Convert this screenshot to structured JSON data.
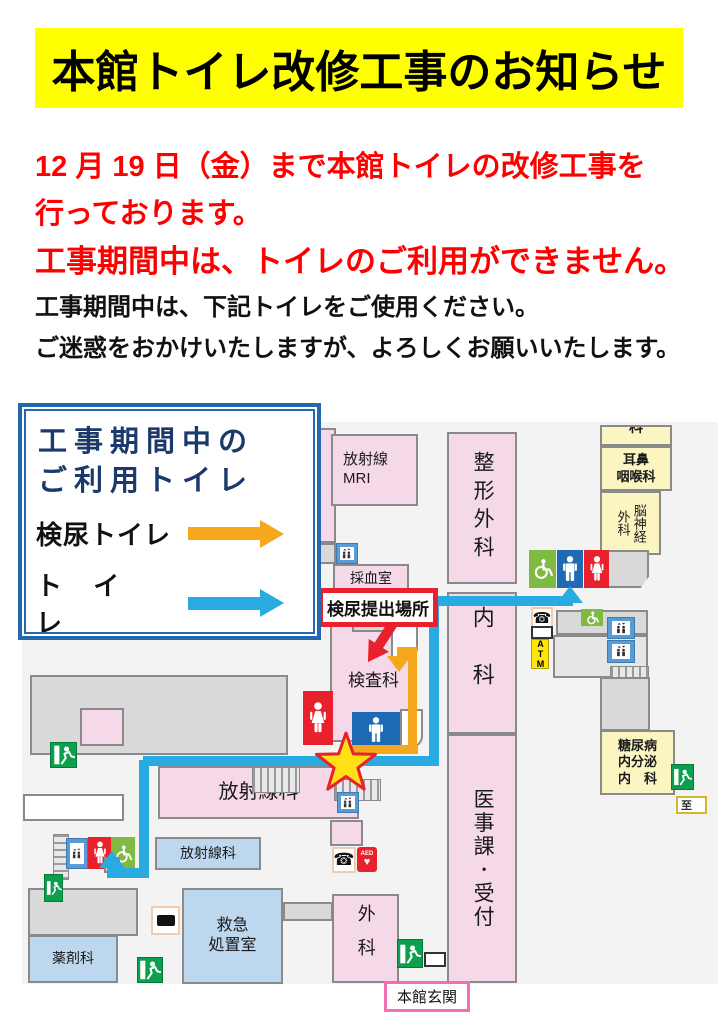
{
  "notice": {
    "title": "本館トイレ改修工事のお知らせ",
    "red_lines": [
      "12 月 19 日（金）まで本館トイレの改修工事を",
      "行っております。",
      "工事期間中は、トイレのご利用ができません。"
    ],
    "black_lines": [
      "工事期間中は、下記トイレをご使用ください。",
      "ご迷惑をおかけいたしますが、よろしくお願いいたします。"
    ]
  },
  "legend": {
    "title": "工事期間中の\nご利用トイレ",
    "items": [
      {
        "label": "検尿トイレ",
        "arrow_color": "#F5A81C"
      },
      {
        "label": "ト イ レ",
        "arrow_color": "#29ABE2"
      }
    ]
  },
  "map": {
    "rooms": {
      "mri": "放射線\nMRI",
      "blood_sampling": "採血室",
      "orthopedics": "整形外科",
      "internal_medicine": "内科",
      "medical_affairs": "医事課･受付",
      "laboratory": "検査科",
      "ent": "耳鼻\n咽喉科",
      "neurosurgery": "脳神経外科",
      "diabetes": "糖尿病\n内分泌\n内　科",
      "radiology_main": "放射線科",
      "radiology_sub": "放射線科",
      "pharmacy": "薬剤科",
      "emergency_room": "救急\n処置室",
      "surgery": "外科",
      "partial_room": "科"
    },
    "signs": {
      "urine_submission": "検尿提出場所",
      "main_entrance": "本館玄関",
      "atm": "ATM",
      "aed": "AED",
      "destination": "至"
    }
  },
  "icons": {
    "phone_glyph": "☎",
    "heart_glyph": "♥"
  },
  "colors": {
    "banner_bg": "#FFFF00",
    "alert_text": "#FF0000",
    "legend_border": "#2267B0",
    "legend_title": "#1B3A6B",
    "urine_route": "#F5A81C",
    "toilet_route": "#29ABE2",
    "room_pink": "#F6D9E8",
    "room_yellow": "#FBF5C1",
    "room_blue": "#BDD7EE",
    "room_gray": "#D9D9D9",
    "toilet_red": "#E8212D",
    "toilet_blue": "#1E6AB4",
    "accessible_green": "#7FBA42",
    "exit_green": "#0BA04E",
    "entrance_border": "#F36FB4",
    "star_fill": "#FFE115"
  }
}
